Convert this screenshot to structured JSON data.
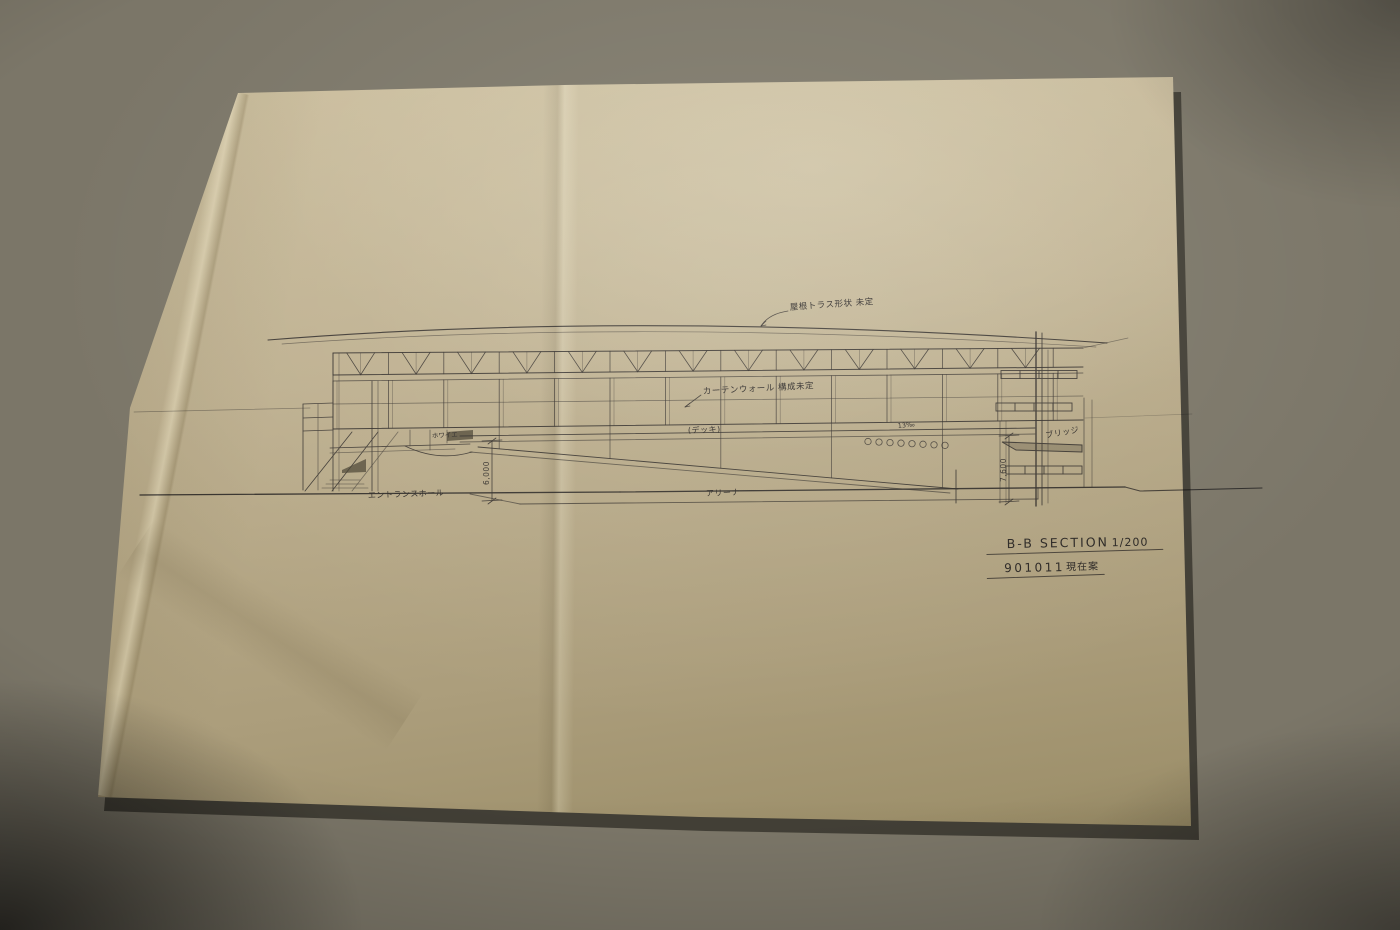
{
  "photo": {
    "background_color": "#7b7668",
    "paper_color": "#beb090",
    "ink_color": "#45444e"
  },
  "drawing": {
    "notes": {
      "roof_truss": "屋根トラス形状 未定",
      "curtain_wall": "カーテンウォール 構成未定"
    },
    "labels": {
      "deck": "(デッキ)",
      "foyer": "ホワイエ",
      "slope": "13‰",
      "bridge": "ブリッジ",
      "entrance_hall": "エントランスホール",
      "arena": "アリーナ"
    },
    "dimensions": {
      "left_height": "6,000",
      "right_height": "7,600"
    },
    "title_block": {
      "section_title": "B-B SECTION",
      "scale": "1/200",
      "drawing_number": "901011",
      "status": "現在案"
    }
  }
}
